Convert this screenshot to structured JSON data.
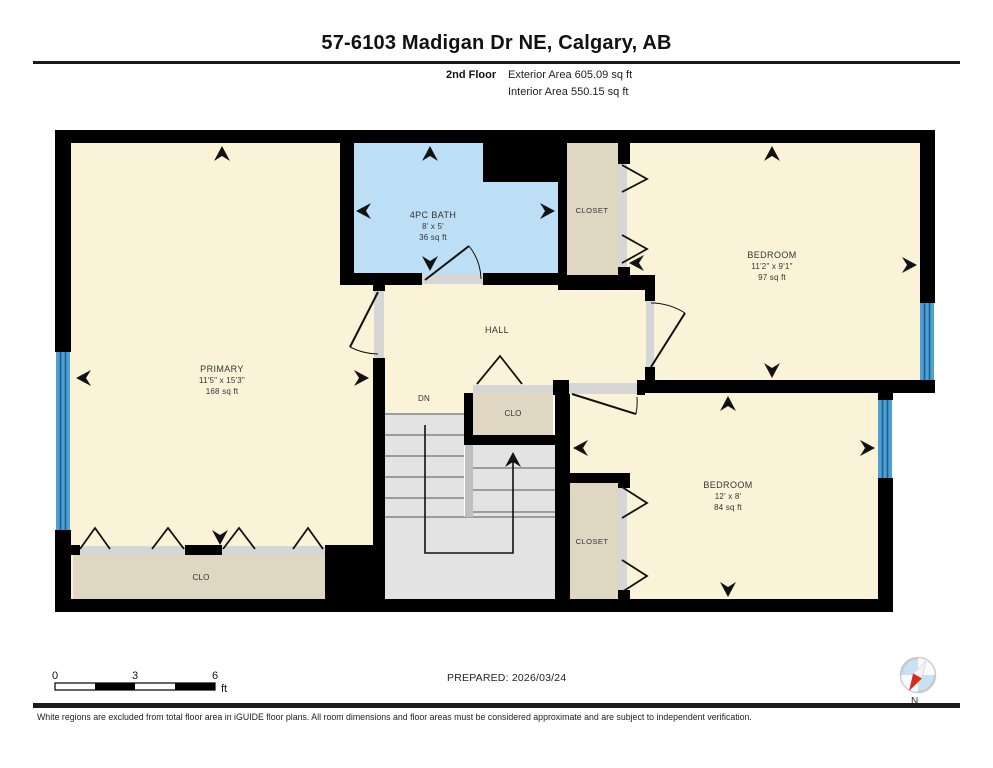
{
  "header": {
    "title": "57-6103 Madigan Dr NE, Calgary, AB",
    "floor_label": "2nd Floor",
    "exterior_area": "Exterior Area 605.09 sq ft",
    "interior_area": "Interior Area 550.15 sq ft"
  },
  "rooms": {
    "bath": {
      "name": "4PC BATH",
      "dims": "8' x 5'",
      "area": "36 sq ft"
    },
    "closet_top": {
      "name": "CLOSET"
    },
    "bedroom_top": {
      "name": "BEDROOM",
      "dims": "11'2\" x 9'1\"",
      "area": "97 sq ft"
    },
    "primary": {
      "name": "PRIMARY",
      "dims": "11'5\" x 15'3\"",
      "area": "168 sq ft"
    },
    "hall": {
      "name": "HALL"
    },
    "stairs_label": "DN",
    "clo_mid": {
      "name": "CLO"
    },
    "closet_bottom": {
      "name": "CLOSET"
    },
    "bedroom_bottom": {
      "name": "BEDROOM",
      "dims": "12' x 8'",
      "area": "84 sq ft"
    },
    "clo_left": {
      "name": "CLO"
    }
  },
  "scale_bar": {
    "tick_0": "0",
    "tick_3": "3",
    "tick_6": "6",
    "unit": "ft"
  },
  "footer": {
    "prepared": "PREPARED: 2026/03/24",
    "compass_label": "N",
    "disclaimer": "White regions are excluded from total floor area in iGUIDE floor plans. All room dimensions and floor areas must be considered approximate and are subject to independent verification."
  },
  "colors": {
    "room_fill": "#FBF3D8",
    "bath_fill": "#BCDFF5",
    "closet_fill": "#E0D7C3",
    "stair_fill": "#E3E3E3",
    "door_track": "#D6D6D6",
    "window_fill": "#4E9FD2",
    "wall": "#000000",
    "compass_red": "#D92B1C"
  }
}
